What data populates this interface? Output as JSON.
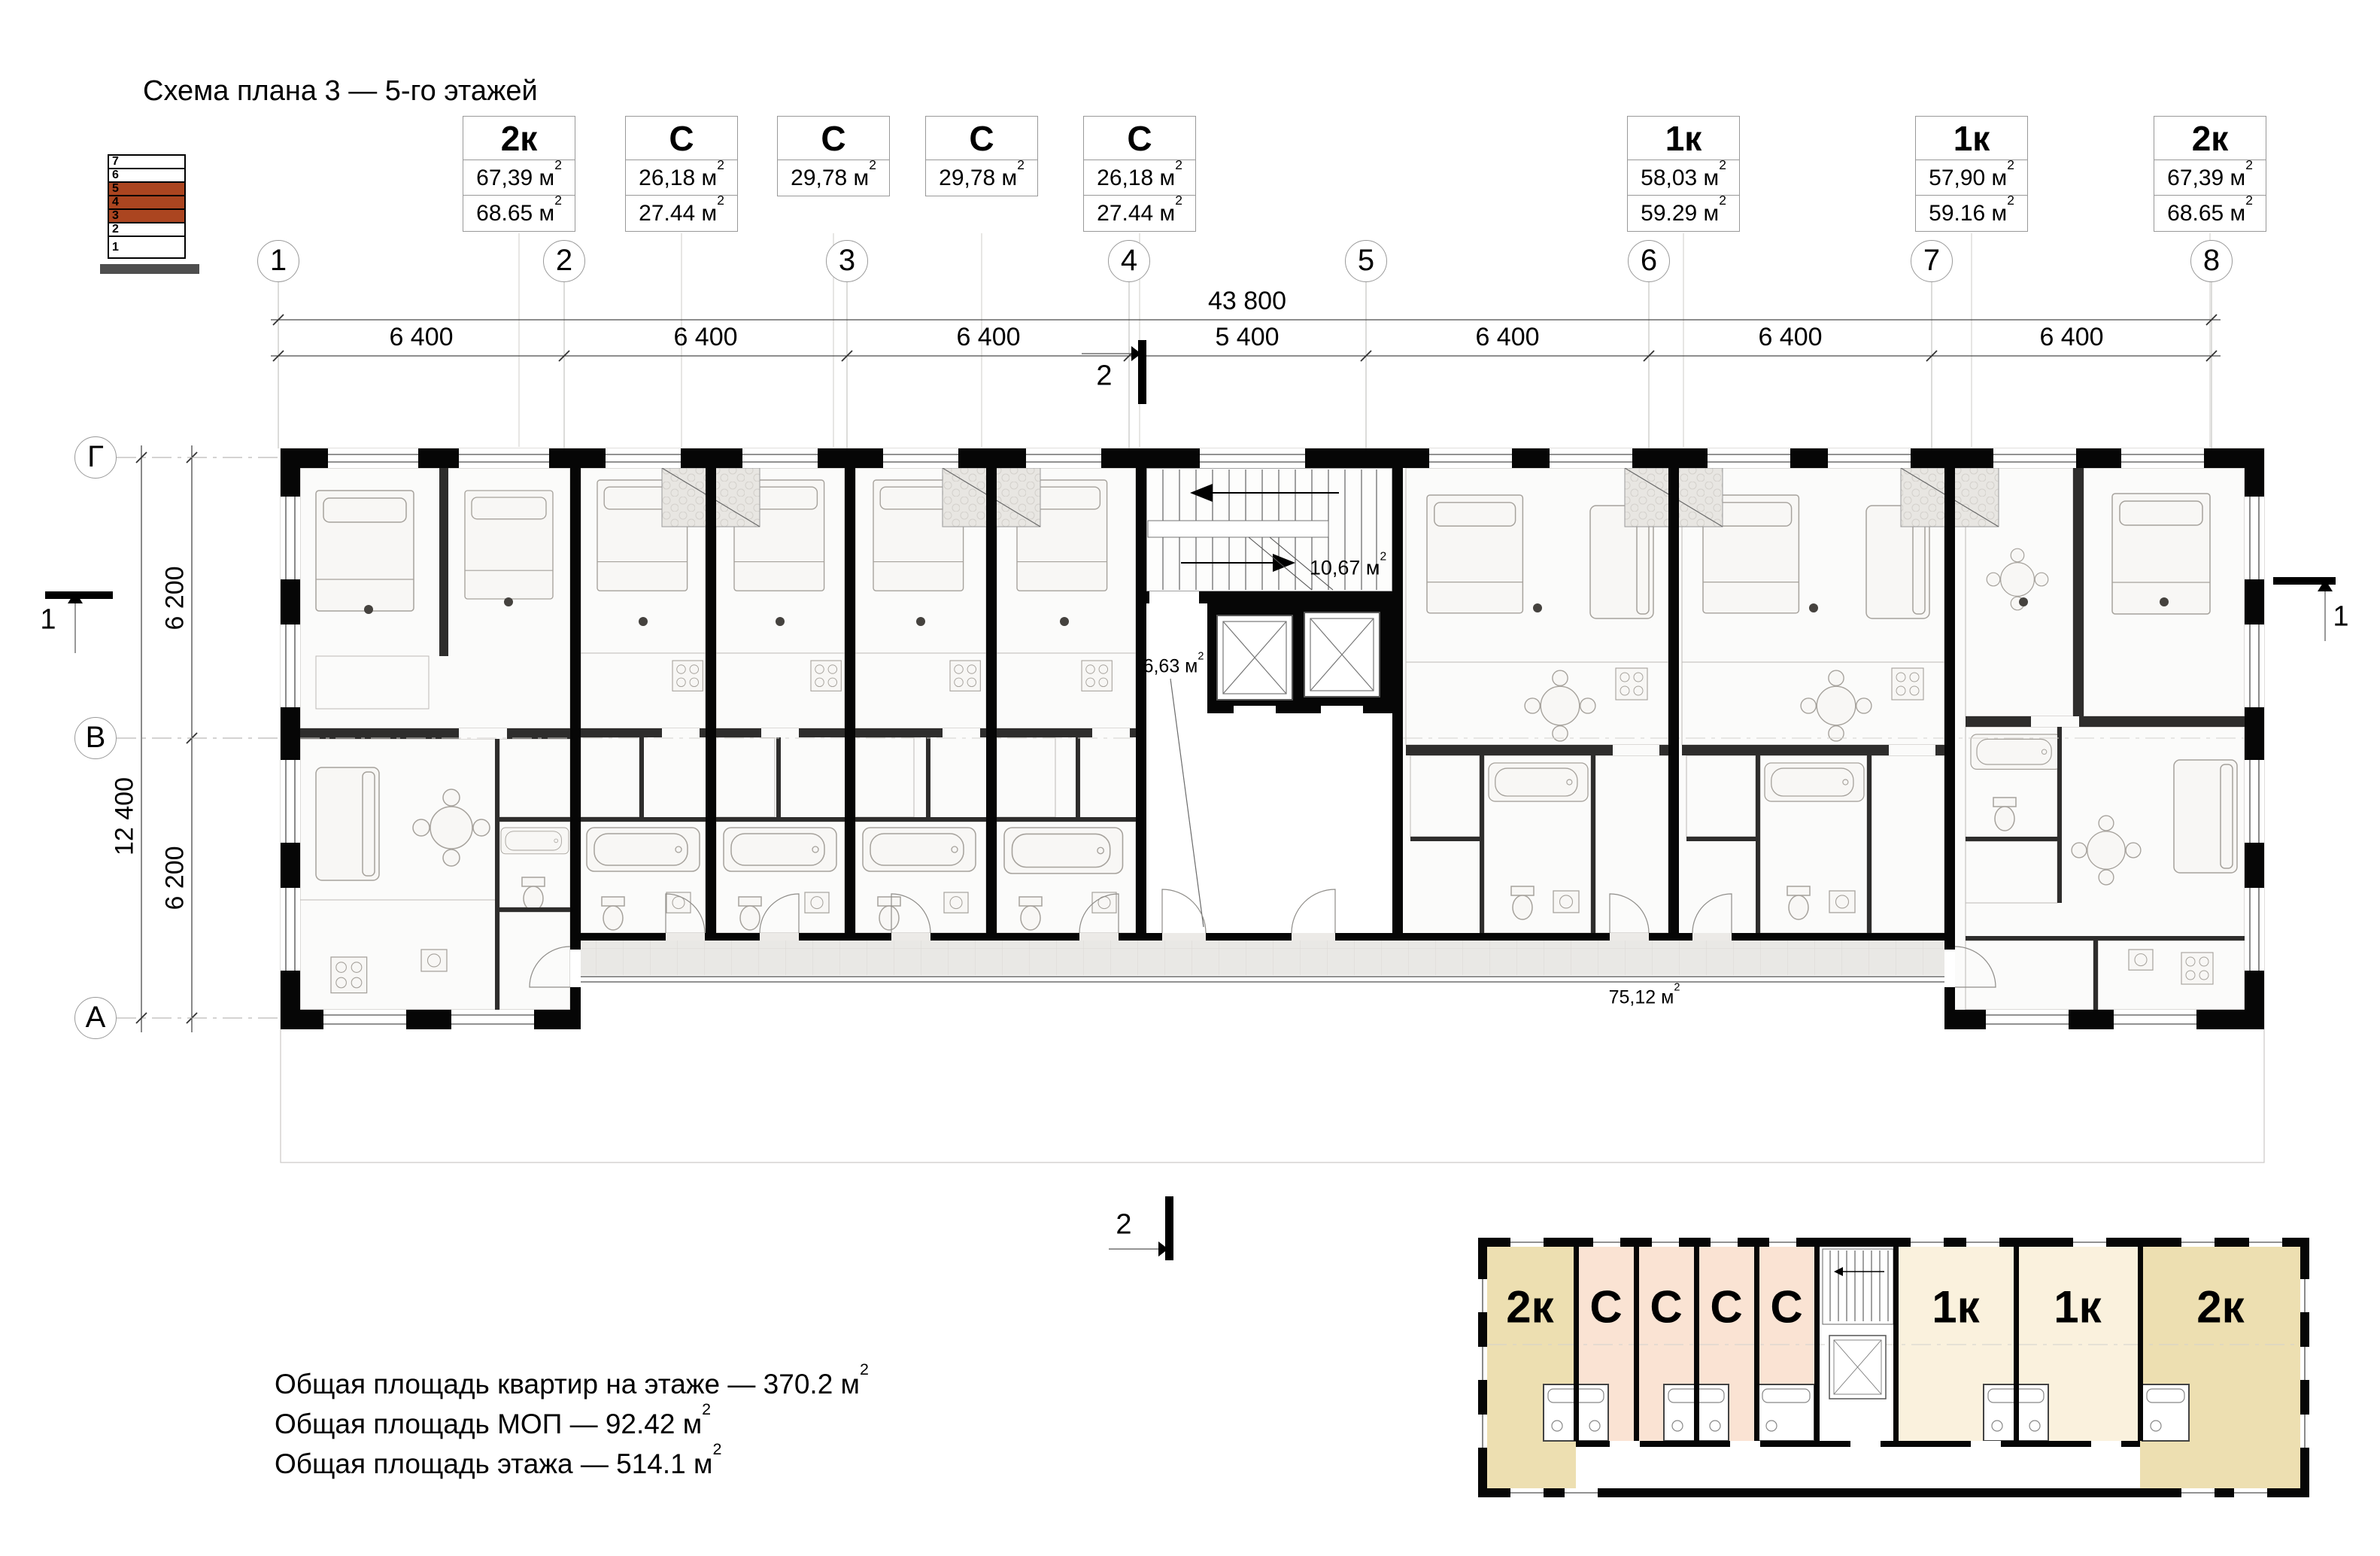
{
  "title": "Схема плана 3 — 5-го этажей",
  "sup2": "2",
  "floor_indicator": {
    "base_color": "#4e4e4e",
    "highlight_color": "#ab4520",
    "floors": [
      {
        "n": "7",
        "hl": false
      },
      {
        "n": "6",
        "hl": false
      },
      {
        "n": "5",
        "hl": true
      },
      {
        "n": "4",
        "hl": true
      },
      {
        "n": "3",
        "hl": true
      },
      {
        "n": "2",
        "hl": false
      },
      {
        "n": "1",
        "hl": false
      }
    ]
  },
  "unit_boxes": [
    {
      "type": "2к",
      "areas": [
        "67,39 м",
        "68.65 м"
      ]
    },
    {
      "type": "С",
      "areas": [
        "26,18 м",
        "27.44 м"
      ]
    },
    {
      "type": "С",
      "areas": [
        "29,78 м"
      ]
    },
    {
      "type": "С",
      "areas": [
        "29,78 м"
      ]
    },
    {
      "type": "С",
      "areas": [
        "26,18 м",
        "27.44 м"
      ]
    },
    {
      "type": "1к",
      "areas": [
        "58,03 м",
        "59.29 м"
      ]
    },
    {
      "type": "1к",
      "areas": [
        "57,90 м",
        "59.16 м"
      ]
    },
    {
      "type": "2к",
      "areas": [
        "67,39 м",
        "68.65 м"
      ]
    }
  ],
  "axes": {
    "cols": [
      "1",
      "2",
      "3",
      "4",
      "5",
      "6",
      "7",
      "8"
    ],
    "rows": [
      "Г",
      "В",
      "А"
    ]
  },
  "dims": {
    "total": "43 800",
    "segments": [
      "6 400",
      "6 400",
      "6 400",
      "5 400",
      "6 400",
      "6 400",
      "6 400"
    ],
    "v_total": "12 400",
    "v_segments": [
      "6 200",
      "6 200"
    ]
  },
  "section_marks": {
    "s1": "1",
    "s2": "2"
  },
  "plan_labels": {
    "stair": "10,67 м",
    "lobby": "6,63 м",
    "corridor": "75,12 м"
  },
  "summary": [
    "Общая площадь квартир на этаже — 370.2 м",
    "Общая площадь МОП — 92.42 м",
    "Общая площадь этажа — 514.1 м"
  ],
  "keyplan": {
    "colors": {
      "two_room": "#eddfb1",
      "studio": "#fae3d3",
      "one_room": "#faf1dd"
    },
    "units": [
      {
        "label": "2к"
      },
      {
        "label": "С"
      },
      {
        "label": "С"
      },
      {
        "label": "С"
      },
      {
        "label": "С"
      },
      {
        "label": "1к"
      },
      {
        "label": "1к"
      },
      {
        "label": "2к"
      }
    ]
  }
}
